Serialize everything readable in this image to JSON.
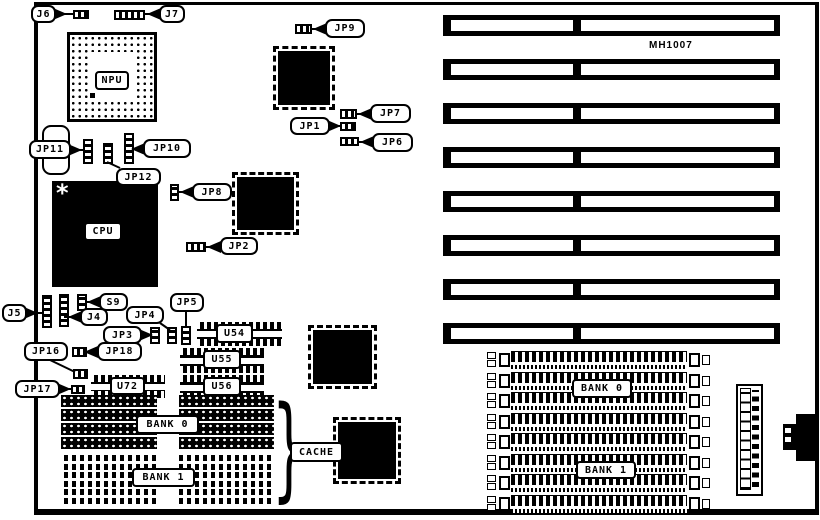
{
  "board": {
    "model": "MH1007"
  },
  "jumpers": {
    "j6": "J6",
    "j7": "J7",
    "jp9": "JP9",
    "jp7": "JP7",
    "jp1": "JP1",
    "jp6": "JP6",
    "jp8": "JP8",
    "jp2": "JP2",
    "jp11": "JP11",
    "jp10": "JP10",
    "jp12": "JP12",
    "j5": "J5",
    "j4": "J4",
    "s9": "S9",
    "jp3": "JP3",
    "jp4": "JP4",
    "jp5": "JP5",
    "jp16": "JP16",
    "jp17": "JP17",
    "jp18": "JP18"
  },
  "chips": {
    "npu": "NPU",
    "cpu": "CPU"
  },
  "sockets": {
    "u54": "U54",
    "u55": "U55",
    "u56": "U56",
    "u72": "U72"
  },
  "memory": {
    "cache": "CACHE",
    "left_bank0": "BANK 0",
    "left_bank1": "BANK 1",
    "right_bank0": "BANK 0",
    "right_bank1": "BANK 1"
  }
}
